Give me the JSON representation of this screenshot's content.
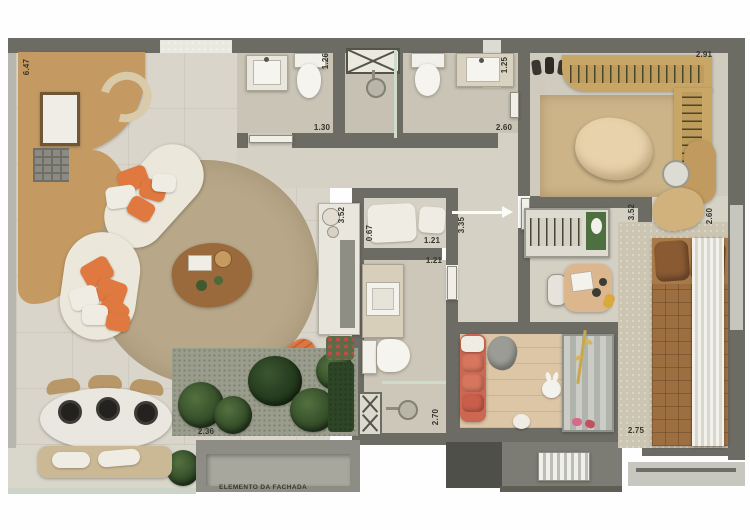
{
  "plan": {
    "type": "apartment-floor-plan-render",
    "facade_label": "ELEMENTO DA FACHADA",
    "dimensions": {
      "kitchen_wall": "6.47",
      "bath1_width": "1.26",
      "bath1_length": "1.30",
      "bath2_width": "1.25",
      "bath2_length": "2.60",
      "closet_width": "2.91",
      "counter_length": "3.52",
      "niche_depth": "0.67",
      "niche_width": "1.21",
      "hall_width": "1.21",
      "entry_hall": "3.35",
      "office_length": "3.52",
      "master_width": "2.60",
      "terrace_width": "2.36",
      "bath3_length": "2.70",
      "kids_room_width": "2.75"
    },
    "colors": {
      "wall": "#6c6c64",
      "wood": "#c49a62",
      "living_floor": "#dad5ca",
      "round_rug": "#b8a788",
      "sofa": "#ece7db",
      "accent_orange": "#e0793f",
      "plant_green": "#34502a",
      "bed_brown": "#9c6e40",
      "kids_sofa_coral": "#cc6752",
      "kids_floor": "#dcc6a6"
    }
  }
}
